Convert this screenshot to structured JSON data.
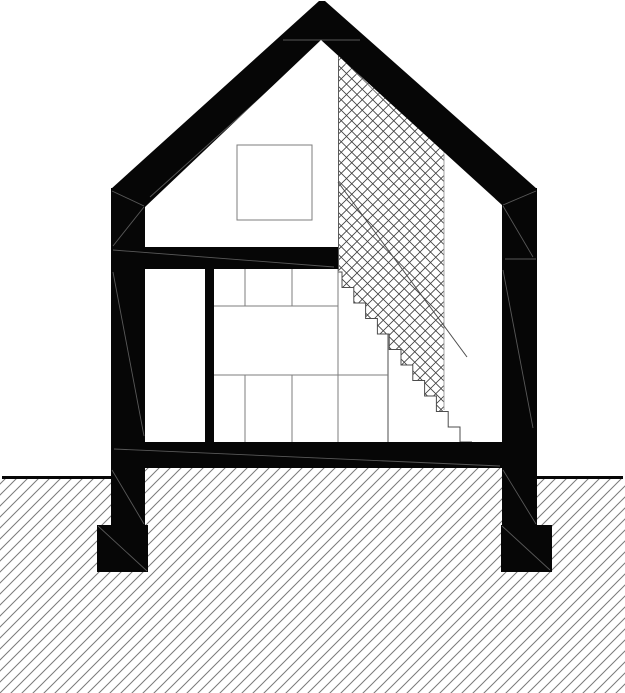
{
  "document": {
    "title": "House cross-section — architectural drawing",
    "type": "building section, gable roof, one and a half storey",
    "background": "#ffffff"
  },
  "colors": {
    "ink": "#060606",
    "white": "#ffffff",
    "thin_gray": "#7d7d7d",
    "stair_line": "#4c4c4c",
    "crosshatch_line": "#3f3f3f",
    "ground_hatch_line": "#7a7a7a",
    "hatch_edge_left": "#5a5a5a",
    "hatch_edge_right": "#9a9a9a"
  },
  "drawing": {
    "canvas": {
      "width": 625,
      "height": 693
    },
    "roof": {
      "description": "gable roof poché band",
      "apex_outer": [
        321,
        1
      ],
      "apex_inner": [
        321,
        40
      ],
      "eave_left_outer": [
        111,
        189
      ],
      "eave_right_outer": [
        537,
        189
      ],
      "eave_left_inner": [
        145,
        207
      ],
      "eave_right_inner": [
        502,
        205
      ]
    },
    "walls": {
      "left": {
        "x": 111,
        "width": 34,
        "top": 188,
        "bottom": 525
      },
      "right": {
        "x": 502,
        "width": 35,
        "top": 188,
        "bottom": 525
      }
    },
    "upper_floor_band": {
      "x1": 111,
      "x2": 338,
      "y1": 247,
      "y2": 269
    },
    "ground_slab": {
      "x1": 111,
      "x2": 537,
      "y1": 442,
      "y2": 468
    },
    "footings": {
      "left": {
        "x": 97,
        "y": 525,
        "w": 51,
        "h": 47
      },
      "right": {
        "x": 501,
        "y": 525,
        "w": 51,
        "h": 47
      }
    },
    "ground": {
      "level_y": 477,
      "line_left": {
        "x1": 2,
        "x2": 111
      },
      "line_right": {
        "x1": 537,
        "x2": 623
      },
      "hatch_angle_deg": 45,
      "hatch_spacing_px": 11
    },
    "stairwell": {
      "crosshatch_left_x": 338,
      "crosshatch_right_x": 444,
      "crosshatch_top_y": 52,
      "risers": 11,
      "riser_height_px": 15.5,
      "tread_depth_px": 11.8,
      "top_nosing": [
        342,
        272
      ],
      "bottom_landing": [
        472,
        442
      ],
      "guide_line": {
        "from": [
          338,
          182
        ],
        "to": [
          467,
          357
        ]
      },
      "under_stair_partition": {
        "x": 388,
        "y1": 334,
        "y2": 442
      },
      "shelf_line": {
        "y": 375,
        "x1": 214,
        "x2": 388
      }
    },
    "window_square": {
      "x": 237,
      "y": 145,
      "w": 75,
      "h": 75
    },
    "interior_post": {
      "x": 205,
      "y": 269,
      "w": 9,
      "h": 173
    },
    "cabinets": {
      "left_x": 214,
      "right_x": 338,
      "top_y": 269,
      "bottom_y": 442,
      "horizontal_lines_y": [
        306,
        375
      ],
      "upper_dividers_x": [
        245,
        292
      ],
      "lower_dividers_x": [
        245,
        292
      ]
    }
  }
}
